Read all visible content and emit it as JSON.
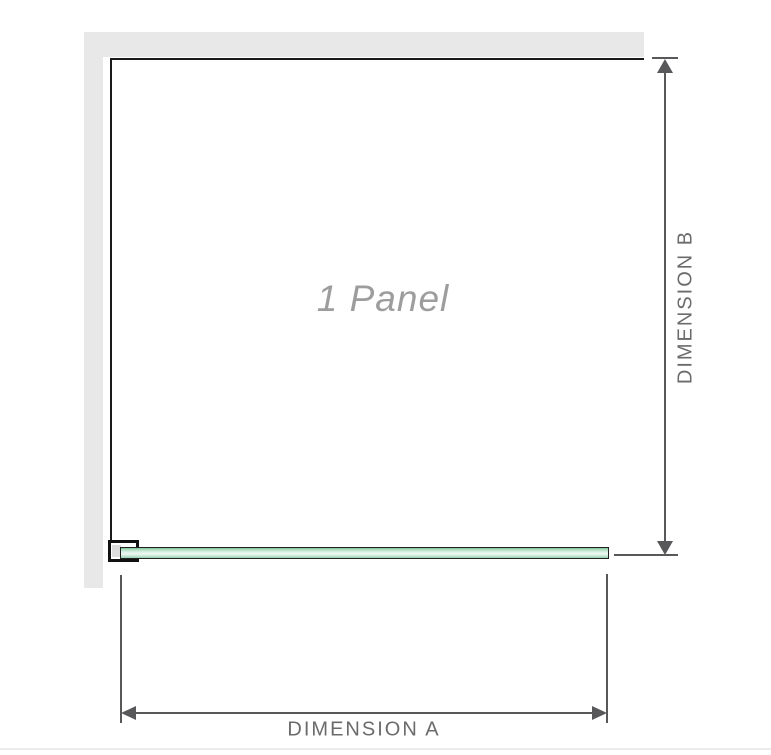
{
  "diagram": {
    "title": "1 Panel",
    "dimensions": {
      "a": {
        "label": "DIMENSION A",
        "orientation": "horizontal"
      },
      "b": {
        "label": "DIMENSION B",
        "orientation": "vertical"
      }
    },
    "icons": {
      "arrow_up": "arrow-up-icon",
      "arrow_down": "arrow-down-icon",
      "arrow_left": "arrow-left-icon",
      "arrow_right": "arrow-right-icon"
    },
    "colors": {
      "wall_gray": "#e8e8e8",
      "panel_outline": "#1a1a1a",
      "dimension_line_gray": "#58585a",
      "dimension_label_gray": "#6b6b6b",
      "panel_label_gray": "#9d9d9d",
      "glass_green_dark": "#7cc298",
      "glass_green_light": "#edf8f1",
      "glass_border": "#222222",
      "bracket_outline": "#111111",
      "bracket_pad_gray": "#dcdcdc"
    }
  }
}
